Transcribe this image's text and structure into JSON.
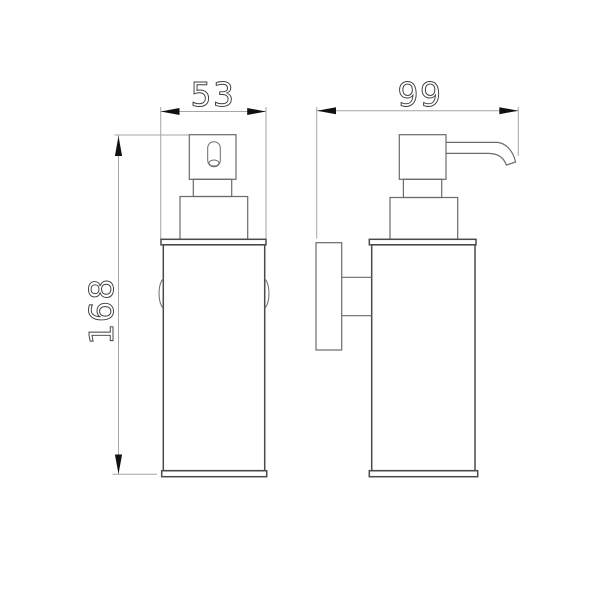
{
  "colors": {
    "background": "#ffffff",
    "object_line": "#6a6a6a",
    "plate_line": "#4a4a4a",
    "dim_line": "#a6a6a6",
    "arrow": "#111111",
    "text": "#3c3c3c"
  },
  "dimensions": {
    "front_width": {
      "label": "53",
      "orientation": "horizontal"
    },
    "side_depth": {
      "label": "99",
      "orientation": "horizontal"
    },
    "overall_height": {
      "label": "168",
      "orientation": "vertical"
    }
  }
}
